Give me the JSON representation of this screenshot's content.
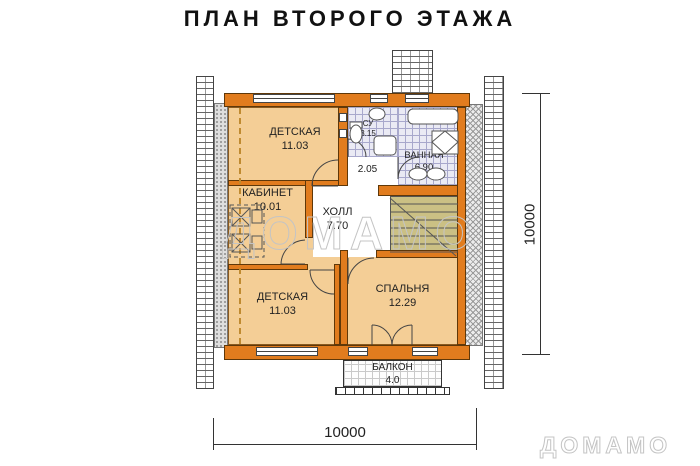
{
  "title": "ПЛАН ВТОРОГО ЭТАЖА",
  "watermarks": {
    "center": "ДОМАМО",
    "corner": "ДОМАМО"
  },
  "rooms": {
    "nursery_top": {
      "name": "ДЕТСКАЯ",
      "area": "11.03"
    },
    "study": {
      "name": "КАБИНЕТ",
      "area": "10.01"
    },
    "hall": {
      "name": "ХОЛЛ",
      "area": "7.70"
    },
    "wc": {
      "name": "СУ",
      "area": "3.15"
    },
    "corridor": {
      "area": "2.05"
    },
    "bathroom": {
      "name": "ВАННАЯ",
      "area": "6.90"
    },
    "nursery_bottom": {
      "name": "ДЕТСКАЯ",
      "area": "11.03"
    },
    "bedroom": {
      "name": "СПАЛЬНЯ",
      "area": "12.29"
    },
    "balcony": {
      "name": "БАЛКОН",
      "area": "4.0"
    }
  },
  "dimensions": {
    "width": "10000",
    "height": "10000"
  },
  "colors": {
    "wall": "#e17c1e",
    "room_fill": "#f4ce96",
    "stair_fill": "#cbc084",
    "tile_line": "#a8a8cc",
    "watermark": "#c4c4c4"
  }
}
